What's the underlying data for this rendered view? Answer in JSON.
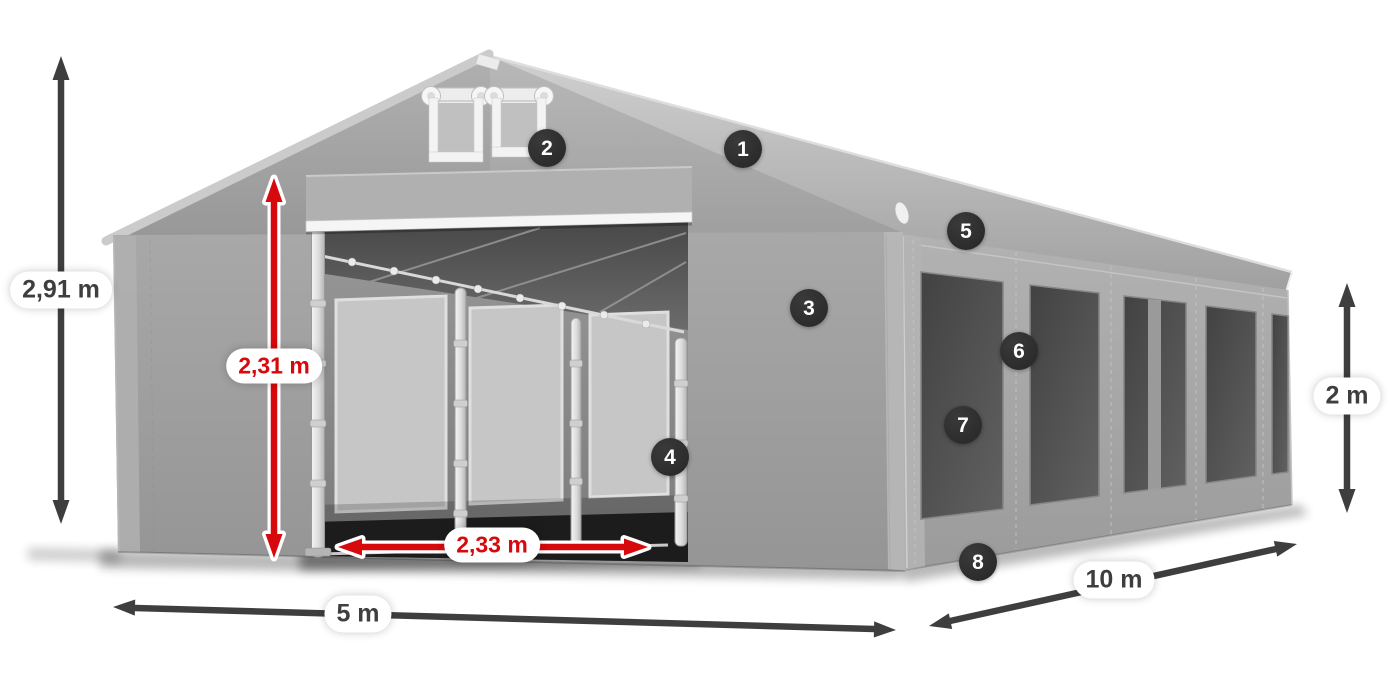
{
  "colors": {
    "accent_red": "#d6090c",
    "arrow_dark": "#3e3e3e",
    "badge_bg": "#262626",
    "badge_text": "#ffffff",
    "canvas_bg": "#ffffff"
  },
  "dimensions": {
    "total_height": "2,91 m",
    "door_height": "2,31 m",
    "door_width": "2,33 m",
    "front_width": "5 m",
    "side_length": "10 m",
    "side_height": "2 m"
  },
  "callouts": [
    {
      "label": "1"
    },
    {
      "label": "2"
    },
    {
      "label": "3"
    },
    {
      "label": "4"
    },
    {
      "label": "5"
    },
    {
      "label": "6"
    },
    {
      "label": "7"
    },
    {
      "label": "8"
    }
  ]
}
